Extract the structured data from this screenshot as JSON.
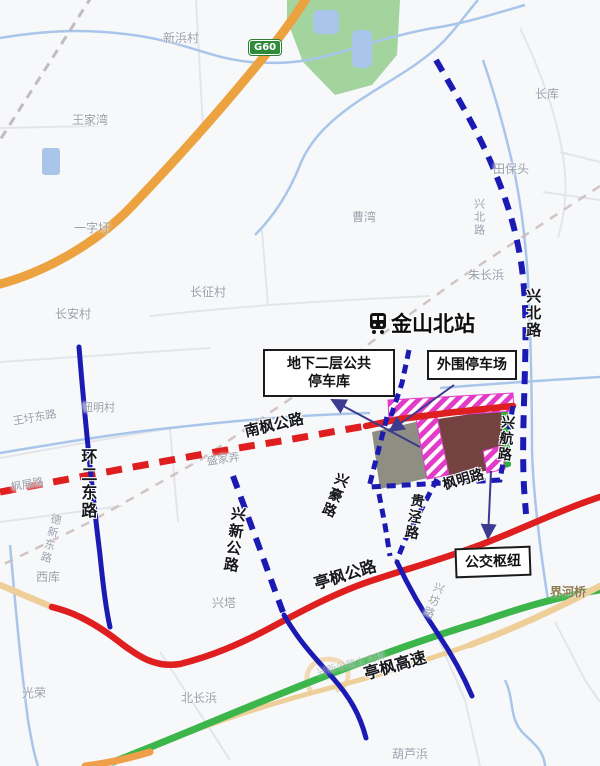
{
  "station": {
    "name": "金山北站",
    "icon": "train-icon"
  },
  "badge": {
    "g60": "G60"
  },
  "callouts": {
    "underground_parking": {
      "line1": "地下二层公共",
      "line2": "停车库"
    },
    "outer_parking": {
      "label": "外围停车场"
    },
    "bus_hub": {
      "label": "公交枢纽"
    }
  },
  "map_labels": [
    {
      "text": "新浜村",
      "x": 163,
      "y": 32,
      "cls": "place"
    },
    {
      "text": "王家湾",
      "x": 72,
      "y": 114,
      "cls": "place"
    },
    {
      "text": "一字圩",
      "x": 74,
      "y": 222,
      "cls": "place"
    },
    {
      "text": "长库",
      "x": 535,
      "y": 88,
      "cls": "place"
    },
    {
      "text": "田保头",
      "x": 493,
      "y": 163,
      "cls": "place"
    },
    {
      "text": "曹湾",
      "x": 352,
      "y": 211,
      "cls": "place"
    },
    {
      "text": "朱长浜",
      "x": 468,
      "y": 269,
      "cls": "place"
    },
    {
      "text": "长征村",
      "x": 190,
      "y": 286,
      "cls": "place"
    },
    {
      "text": "长安村",
      "x": 55,
      "y": 308,
      "cls": "place"
    },
    {
      "text": "钮明村",
      "x": 82,
      "y": 402,
      "cls": "place",
      "size": 11
    },
    {
      "text": "王圩东路",
      "x": 12,
      "y": 416,
      "cls": "place",
      "rot": -10,
      "size": 11
    },
    {
      "text": "枫展路",
      "x": 10,
      "y": 482,
      "cls": "place",
      "rot": -10,
      "size": 11
    },
    {
      "text": "盛家弄",
      "x": 206,
      "y": 456,
      "cls": "place",
      "rot": -8,
      "size": 11
    },
    {
      "text": "德新东路",
      "x": 50,
      "y": 512,
      "cls": "place",
      "vert": true,
      "rot": 14,
      "size": 11
    },
    {
      "text": "西库",
      "x": 36,
      "y": 571,
      "cls": "place"
    },
    {
      "text": "兴塔",
      "x": 212,
      "y": 597,
      "cls": "place"
    },
    {
      "text": "光荣",
      "x": 22,
      "y": 687,
      "cls": "place"
    },
    {
      "text": "北长浜",
      "x": 181,
      "y": 692,
      "cls": "place"
    },
    {
      "text": "兴坊路",
      "x": 434,
      "y": 580,
      "cls": "place",
      "vert": true,
      "rot": 22,
      "size": 11
    },
    {
      "text": "葫芦浜",
      "x": 392,
      "y": 748,
      "cls": "place"
    },
    {
      "text": "兴新公路立交桥",
      "x": 316,
      "y": 668,
      "cls": "place",
      "rot": -14,
      "size": 10,
      "op": 0.6
    },
    {
      "text": "界河桥",
      "x": 550,
      "y": 586,
      "cls": "bridge"
    },
    {
      "text": "兴北路",
      "x": 472,
      "y": 198,
      "cls": "place",
      "vert": true,
      "size": 11
    },
    {
      "text": "兴北路",
      "x": 524,
      "y": 288,
      "cls": "road-bold",
      "vert": true,
      "size": 15
    },
    {
      "text": "兴航路",
      "x": 500,
      "y": 414,
      "cls": "road-bold",
      "vert": true,
      "rot": 6
    },
    {
      "text": "枫明路",
      "x": 441,
      "y": 478,
      "cls": "road-bold",
      "rot": -16
    },
    {
      "text": "贵泾路",
      "x": 410,
      "y": 492,
      "cls": "road-bold",
      "vert": true,
      "rot": 10
    },
    {
      "text": "兴豪路",
      "x": 336,
      "y": 470,
      "cls": "road-bold",
      "vert": true,
      "rot": 22
    },
    {
      "text": "南枫公路",
      "x": 243,
      "y": 424,
      "cls": "road-bold",
      "rot": -13,
      "size": 15
    },
    {
      "text": "环二东路",
      "x": 78,
      "y": 448,
      "cls": "road-bold",
      "vert": true,
      "size": 16
    },
    {
      "text": "兴新公路",
      "x": 230,
      "y": 505,
      "cls": "road-bold",
      "vert": true,
      "rot": 8,
      "size": 15
    },
    {
      "text": "亭枫公路",
      "x": 312,
      "y": 576,
      "cls": "road-bold",
      "rot": -17,
      "size": 16
    },
    {
      "text": "亭枫高速",
      "x": 362,
      "y": 666,
      "cls": "road-bold",
      "rot": -16,
      "size": 16
    }
  ],
  "colors": {
    "background": "#f7f8fa",
    "water": "#a9c6ea",
    "greenspace": "#a4d49e",
    "highway_orange": "#eba23f",
    "expressway_green": "#3cb54a",
    "road_red": "#df1f1f",
    "road_blue": "#1b1bb3",
    "road_tan": "#eecf9a",
    "railway_gray": "#bab2b4",
    "hatch_magenta": "#e23bc8",
    "parcel_gray": "#8e8e82",
    "parcel_brown": "#744341",
    "strip_green": "#2fae3a",
    "callout_border": "#1a1a1a",
    "arrow": "#3b3b8f",
    "g60_badge": "#2e8b3a"
  }
}
